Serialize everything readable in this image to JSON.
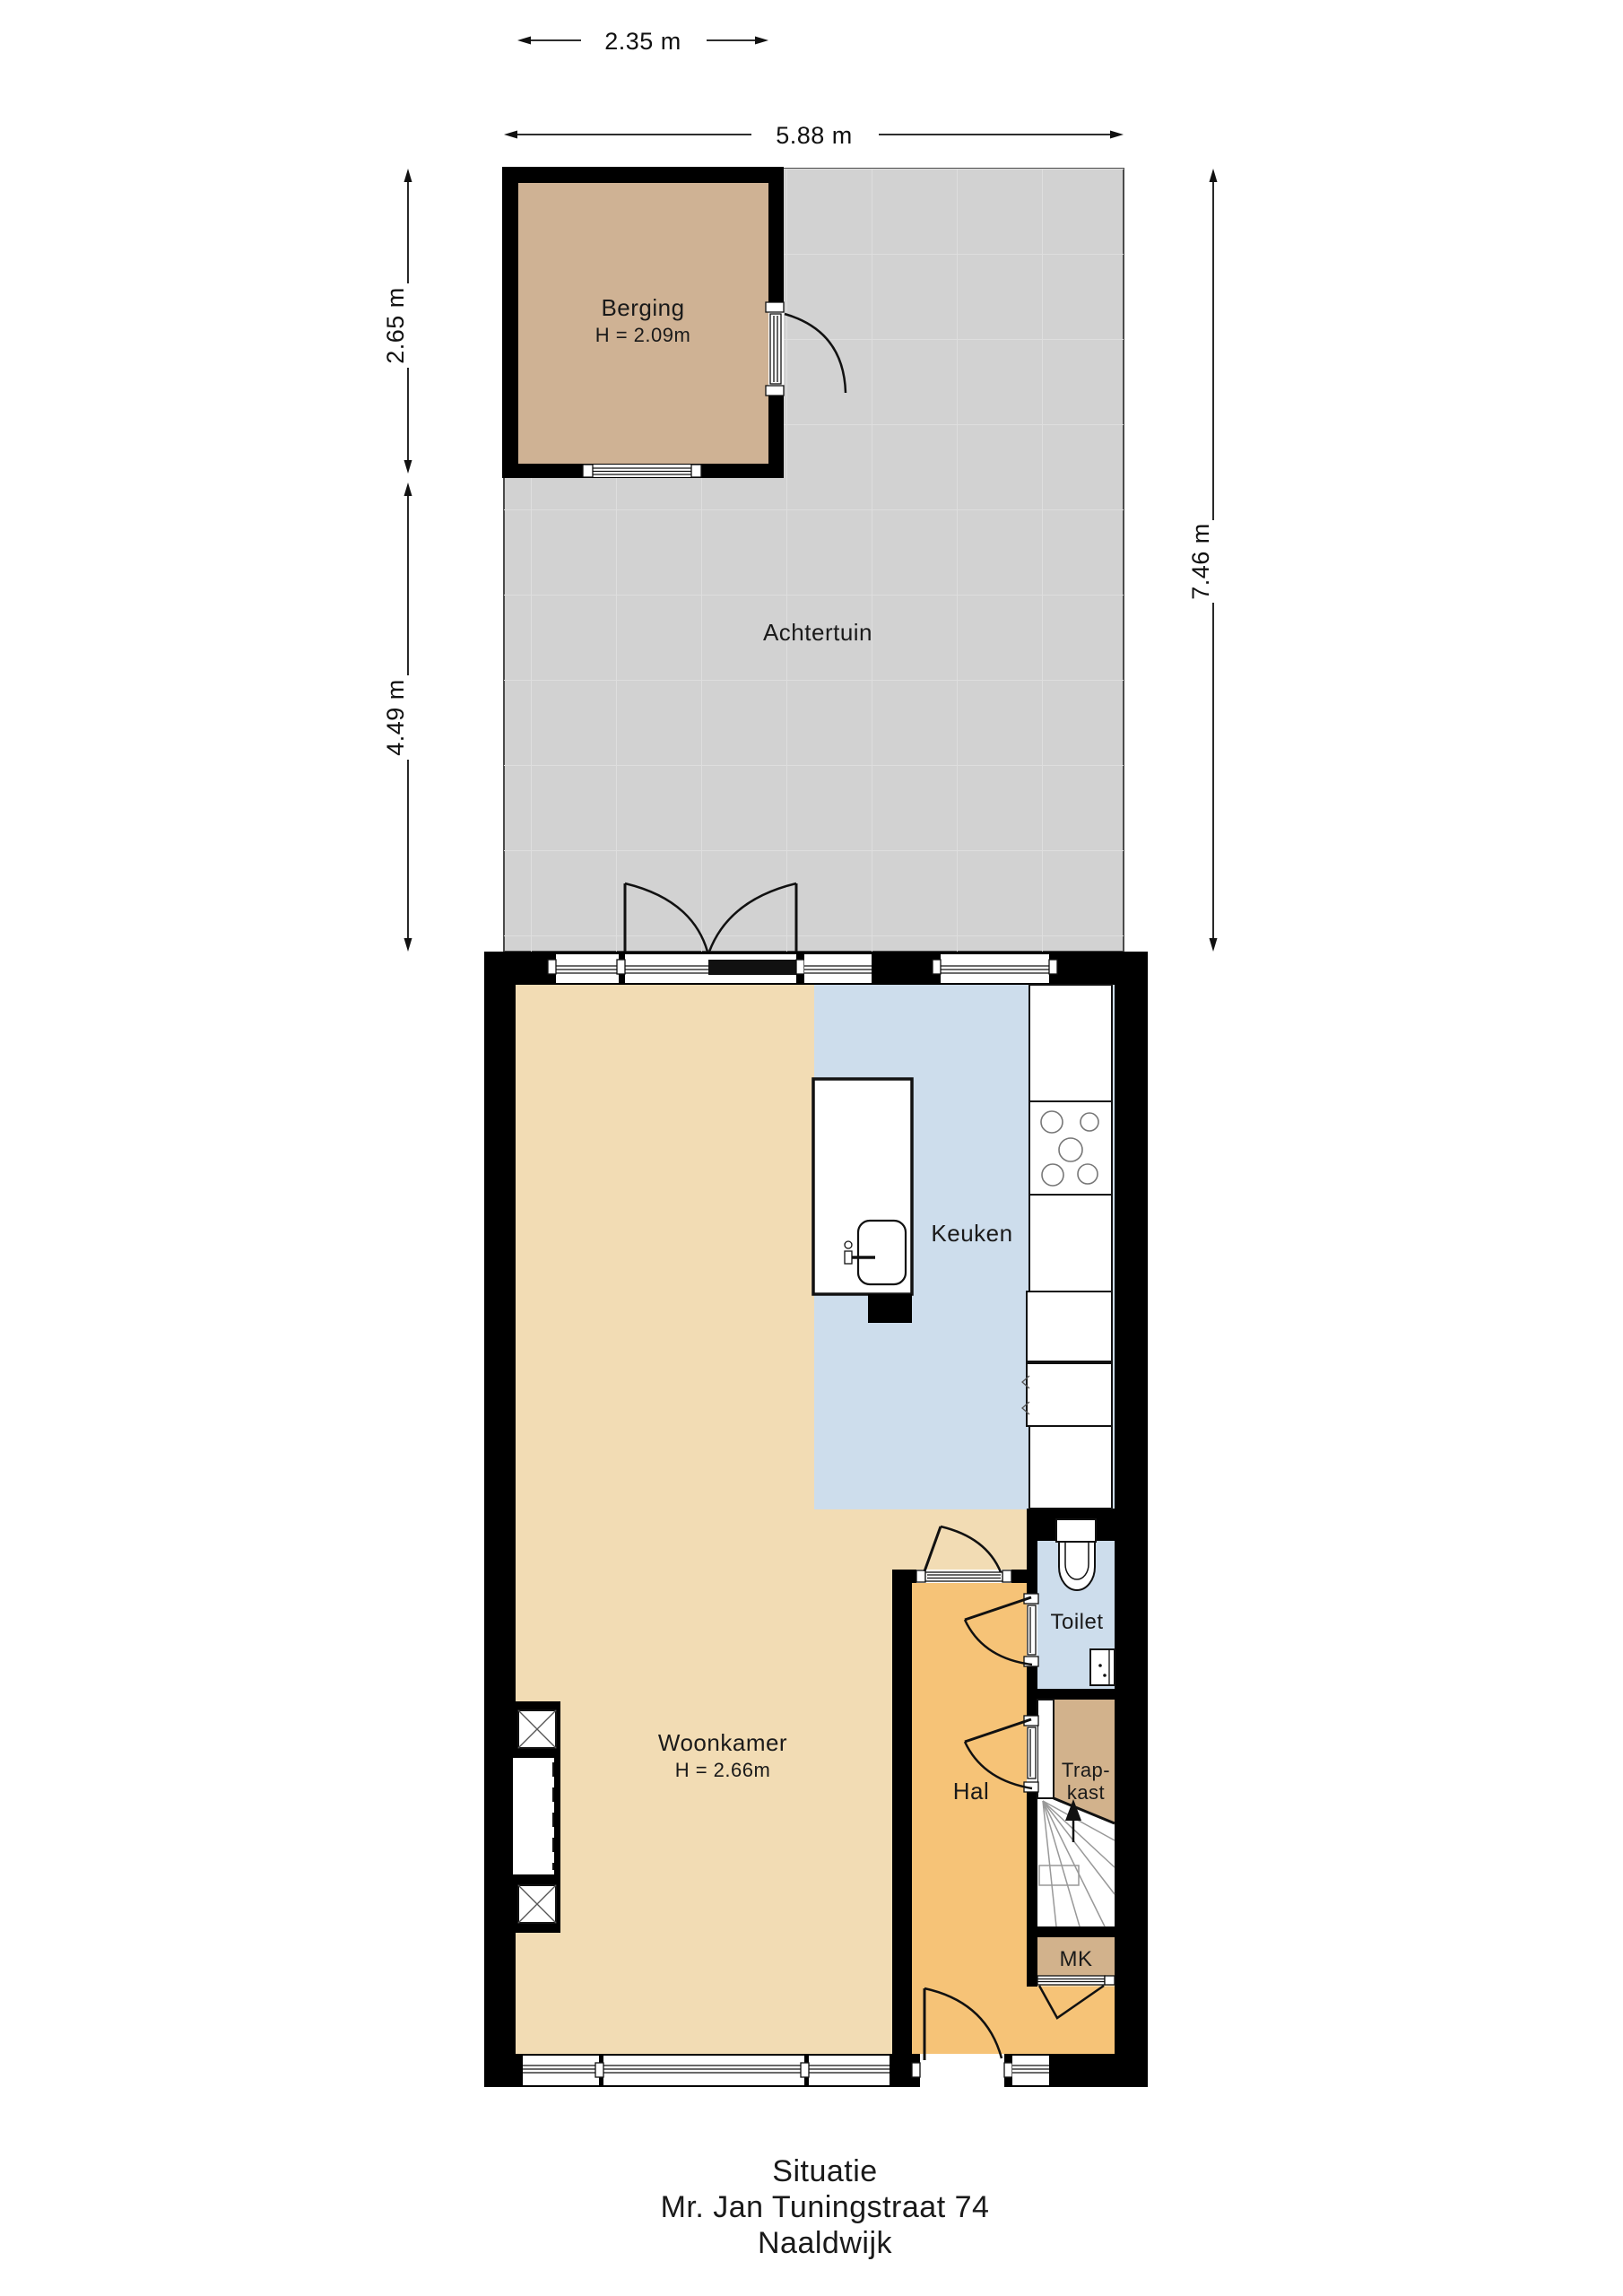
{
  "title": {
    "line1": "Situatie",
    "line2": "Mr. Jan Tuningstraat 74",
    "line3": "Naaldwijk"
  },
  "dimensions": {
    "berging_width": "2.35 m",
    "plot_width": "5.88 m",
    "berging_height": "2.65 m",
    "garden_height": "4.49 m",
    "plot_height": "7.46 m"
  },
  "rooms": {
    "berging": {
      "name": "Berging",
      "ceiling_height": "H = 2.09m"
    },
    "achtertuin": {
      "name": "Achtertuin"
    },
    "keuken": {
      "name": "Keuken"
    },
    "woonkamer": {
      "name": "Woonkamer",
      "ceiling_height": "H = 2.66m"
    },
    "hal": {
      "name": "Hal"
    },
    "toilet": {
      "name": "Toilet"
    },
    "trapkast": {
      "name_line1": "Trap-",
      "name_line2": "kast"
    },
    "meterkast": {
      "name": "MK"
    }
  },
  "colors": {
    "wall": "#000000",
    "achtertuin": "#d2d2d2",
    "achtertuin_grid": "#dedede",
    "berging": "#cfb294",
    "woonkamer": "#f2dcb4",
    "keuken": "#cdddec",
    "toilet": "#cdddec",
    "hal": "#f6c377",
    "kast": "#d2b28c",
    "stairs": "#ffffff"
  }
}
